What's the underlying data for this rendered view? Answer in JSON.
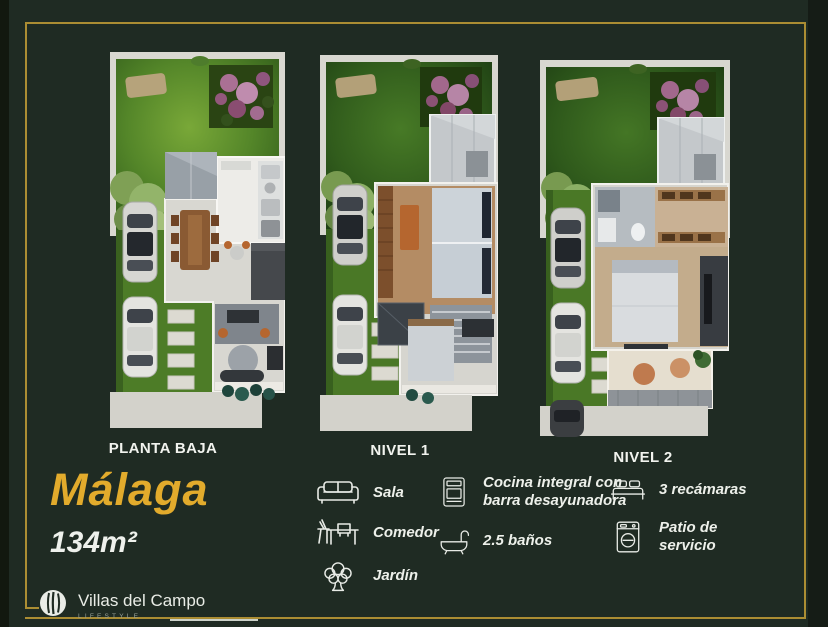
{
  "theme": {
    "background": "#1f2b23",
    "frame_gold": "#ab8d33",
    "title_gold": "#e2ab2c",
    "text_white": "#eef1ec"
  },
  "floorplans": [
    {
      "label": "PLANTA BAJA"
    },
    {
      "label": "NIVEL 1"
    },
    {
      "label": "NIVEL 2"
    }
  ],
  "model": {
    "name": "Málaga",
    "area": "134m²"
  },
  "amenities": [
    {
      "icon": "sofa-icon",
      "label": "Sala"
    },
    {
      "icon": "dining-table-icon",
      "label": "Comedor"
    },
    {
      "icon": "tree-icon",
      "label": "Jardín"
    },
    {
      "icon": "stove-icon",
      "label": "Cocina integral con barra desayunadora"
    },
    {
      "icon": "bathtub-icon",
      "label": "2.5 baños"
    },
    {
      "icon": "bed-icon",
      "label": "3 recámaras"
    },
    {
      "icon": "washing-machine-icon",
      "label": "Patio de servicio"
    }
  ],
  "brand": {
    "name": "Villas del Campo",
    "tagline": "LIFESTYLE"
  }
}
